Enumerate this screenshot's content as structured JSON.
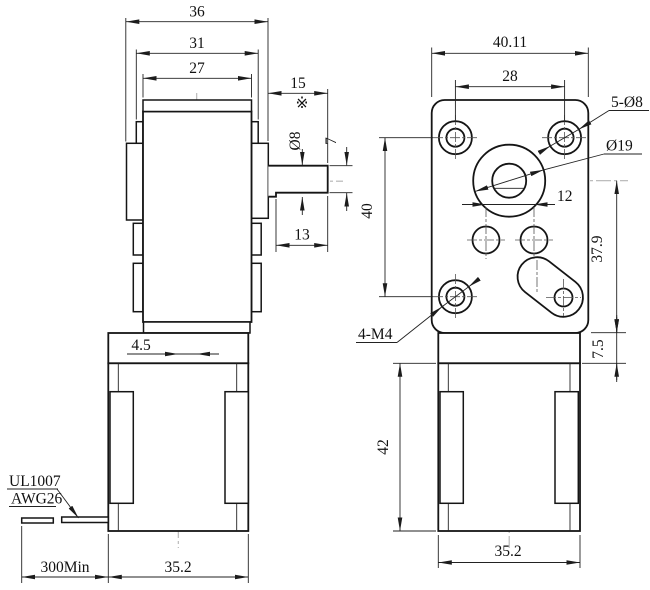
{
  "colors": {
    "background": "#ffffff",
    "object_line": "#151515",
    "dimension_line": "#222222",
    "centerline": "#b4b4b4"
  },
  "side_view": {
    "width_top": "36",
    "width_mid": "31",
    "width_body": "27",
    "shaft_length": "15",
    "reference_mark": "※",
    "shaft_diameter": "Ø8",
    "shaft_flat_height": "7",
    "shaft_flat_length": "13",
    "axis_offset": "4.5",
    "wire_spec_line1": "UL1007",
    "wire_spec_line2": "AWG26",
    "wire_length": "300Min",
    "motor_width": "35.2"
  },
  "front_view": {
    "plate_width": "40.11",
    "hole_spacing": "28",
    "mount_holes": "5-Ø8",
    "boss_diameter": "Ø19",
    "gear_hole_spacing": "12",
    "hole_vertical_span": "40",
    "center_to_bottom": "37.9",
    "thread_holes": "4-M4",
    "plate_offset": "7.5",
    "motor_height": "42",
    "motor_width": "35.2"
  }
}
